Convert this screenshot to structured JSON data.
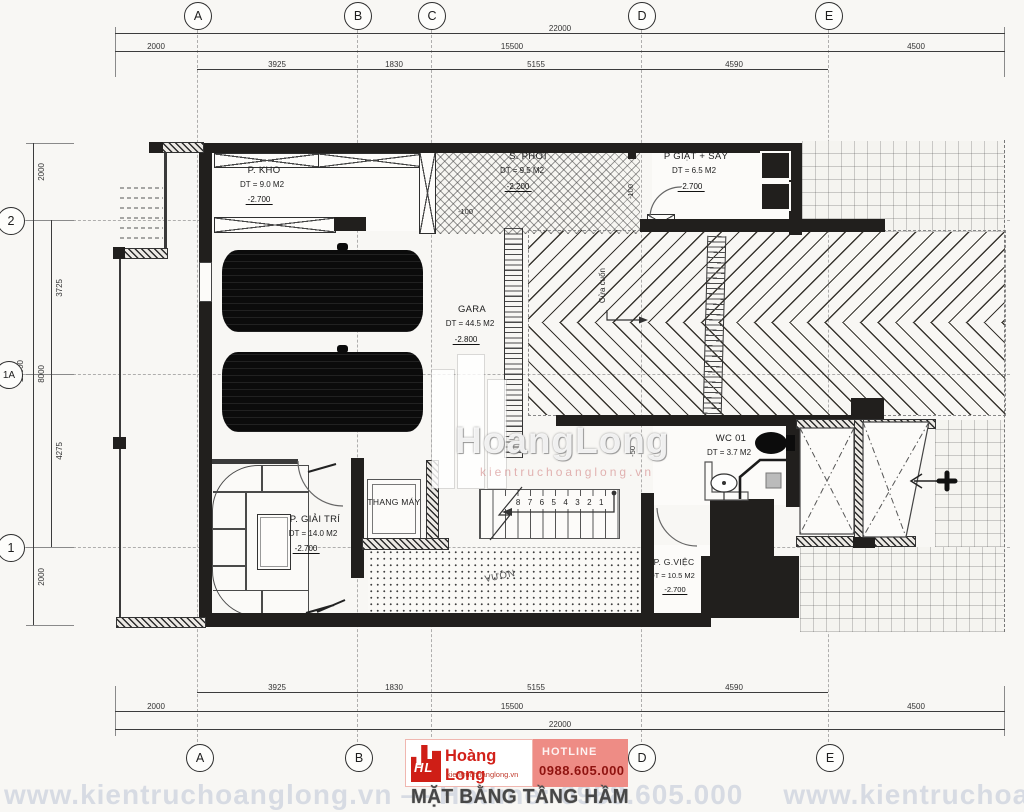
{
  "drawing": {
    "title": "MẶT BẰNG TẦNG HẦM"
  },
  "grid": {
    "cols": [
      "A",
      "B",
      "C",
      "D",
      "E"
    ],
    "rows": [
      "2",
      "1A",
      "1"
    ]
  },
  "dims": {
    "top_total": "22000",
    "top_mid": [
      "2000",
      "15500",
      "4500"
    ],
    "top_detail": [
      "3925",
      "1830",
      "5155",
      "4590"
    ],
    "left_total": "12000",
    "left_mid": [
      "2000",
      "8000",
      "2000"
    ],
    "left_detail": [
      "3725",
      "4275"
    ]
  },
  "rooms": {
    "kho": {
      "name": "P. KHO",
      "area": "DT = 9.0 M2",
      "level": "-2.700"
    },
    "phoi": {
      "name": "S. PHƠI",
      "area": "DT = 9.5 M2",
      "level": "-2.200"
    },
    "giat": {
      "name": "P GIẶT + SẤY",
      "area": "DT = 6.5 M2",
      "level": "-2.700"
    },
    "gara": {
      "name": "GARA",
      "area": "DT = 44.5 M2",
      "level": "-2.800"
    },
    "giaitri": {
      "name": "P. GIẢI TRÍ",
      "area": "DT = 14.0 M2",
      "level": "-2.700"
    },
    "thangmay": {
      "name": "THANG MÁY"
    },
    "wc": {
      "name": "WC 01",
      "area": "DT = 3.7 M2"
    },
    "gviec": {
      "name": "P. G.VIỆC",
      "area": "DT = 10.5 M2",
      "level": "-2.700"
    },
    "vuon": {
      "name": "VƯỜN"
    }
  },
  "annotations": {
    "cua_cuon": "Cửa cuốn",
    "stair_numbers": "8 7 6 5 4 3 2 1",
    "lvl_100a": "-100",
    "lvl_100b": "-100",
    "lvl_50": "-50"
  },
  "branding": {
    "logo_initials": "HL",
    "company": "Hoàng Long",
    "website": "kientruchoanglong.vn",
    "hotline_label": "HOTLINE",
    "hotline_number": "0988.605.000",
    "accent_red": "#d2211a",
    "accent_pink": "#ee8c85"
  },
  "watermark": {
    "main": "HoangLong",
    "sub": "kientruchoanglong.vn",
    "bottom": "www.kientruchoanglong.vn — Hotline: 0988.605.000"
  }
}
